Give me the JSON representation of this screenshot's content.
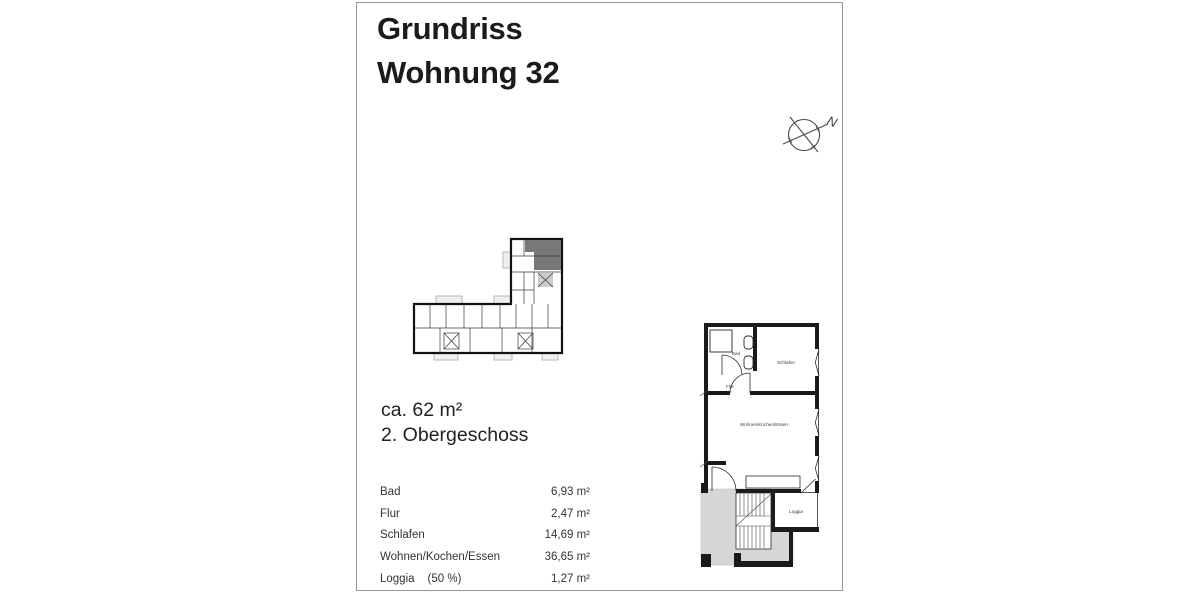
{
  "title": {
    "line1": "Grundriss",
    "line2": "Wohnung 32"
  },
  "compass": {
    "north_label": "N"
  },
  "summary": {
    "area": "ca. 62 m²",
    "floor": "2. Obergeschoss"
  },
  "rooms": {
    "rows": [
      {
        "name": "Bad",
        "note": "",
        "value": "6,93 m²"
      },
      {
        "name": "Flur",
        "note": "",
        "value": "2,47 m²"
      },
      {
        "name": "Schlafen",
        "note": "",
        "value": "14,69 m²"
      },
      {
        "name": "Wohnen/Kochen/Essen",
        "note": "",
        "value": "36,65 m²"
      },
      {
        "name": "Loggia",
        "note": "(50 %)",
        "value": "1,27 m²"
      }
    ]
  },
  "floorplan_labels": {
    "bad": "Bad",
    "flur": "Flur",
    "schlafen": "Schlafen",
    "wohnen": "Wohnen/Kochen/Essen",
    "loggia": "Loggia"
  },
  "colors": {
    "wall": "#1a1a1a",
    "highlight_unit": "#787878",
    "stairwell_gray": "#d6d6d6",
    "mini_stair_gray": "#cccccc"
  }
}
